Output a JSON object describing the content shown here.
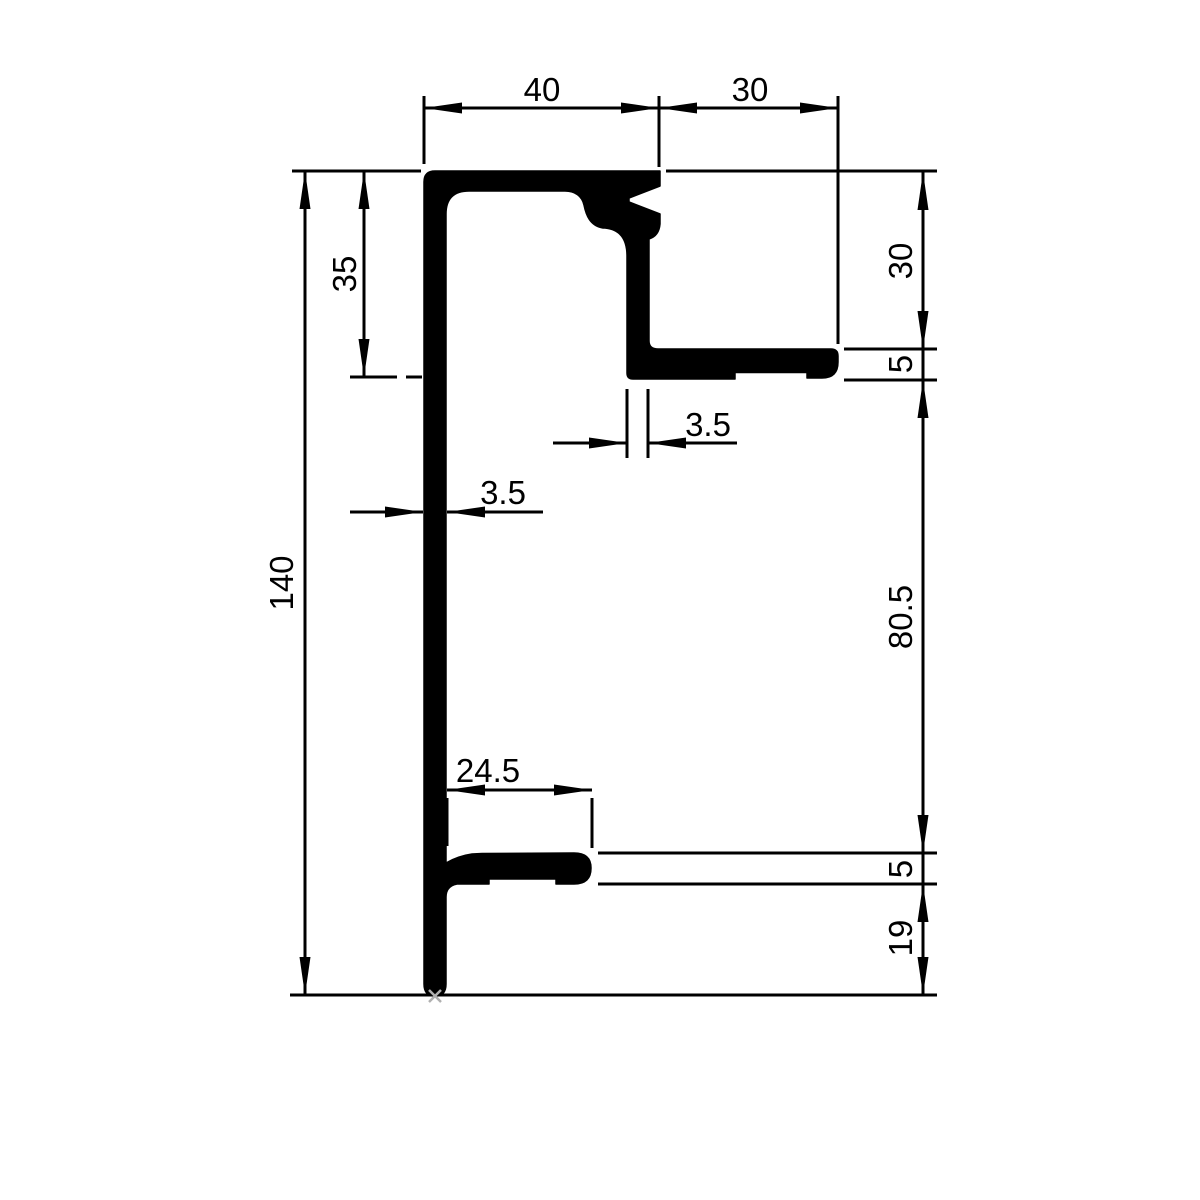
{
  "title": "Aluminium extrusion profile cross-section, dimensioned technical drawing",
  "colors": {
    "background": "#ffffff",
    "line": "#000000",
    "origin_marker": "#b0b0b0"
  },
  "dimensions": {
    "top_40": "40",
    "top_30": "30",
    "left_140": "140",
    "left_35": "35",
    "right_30": "30",
    "right_5_upper": "5",
    "right_80_5": "80.5",
    "right_5_lower": "5",
    "right_19": "19",
    "wall_3_5_mid": "3.5",
    "wall_3_5_left": "3.5",
    "bottom_24_5": "24.5"
  }
}
